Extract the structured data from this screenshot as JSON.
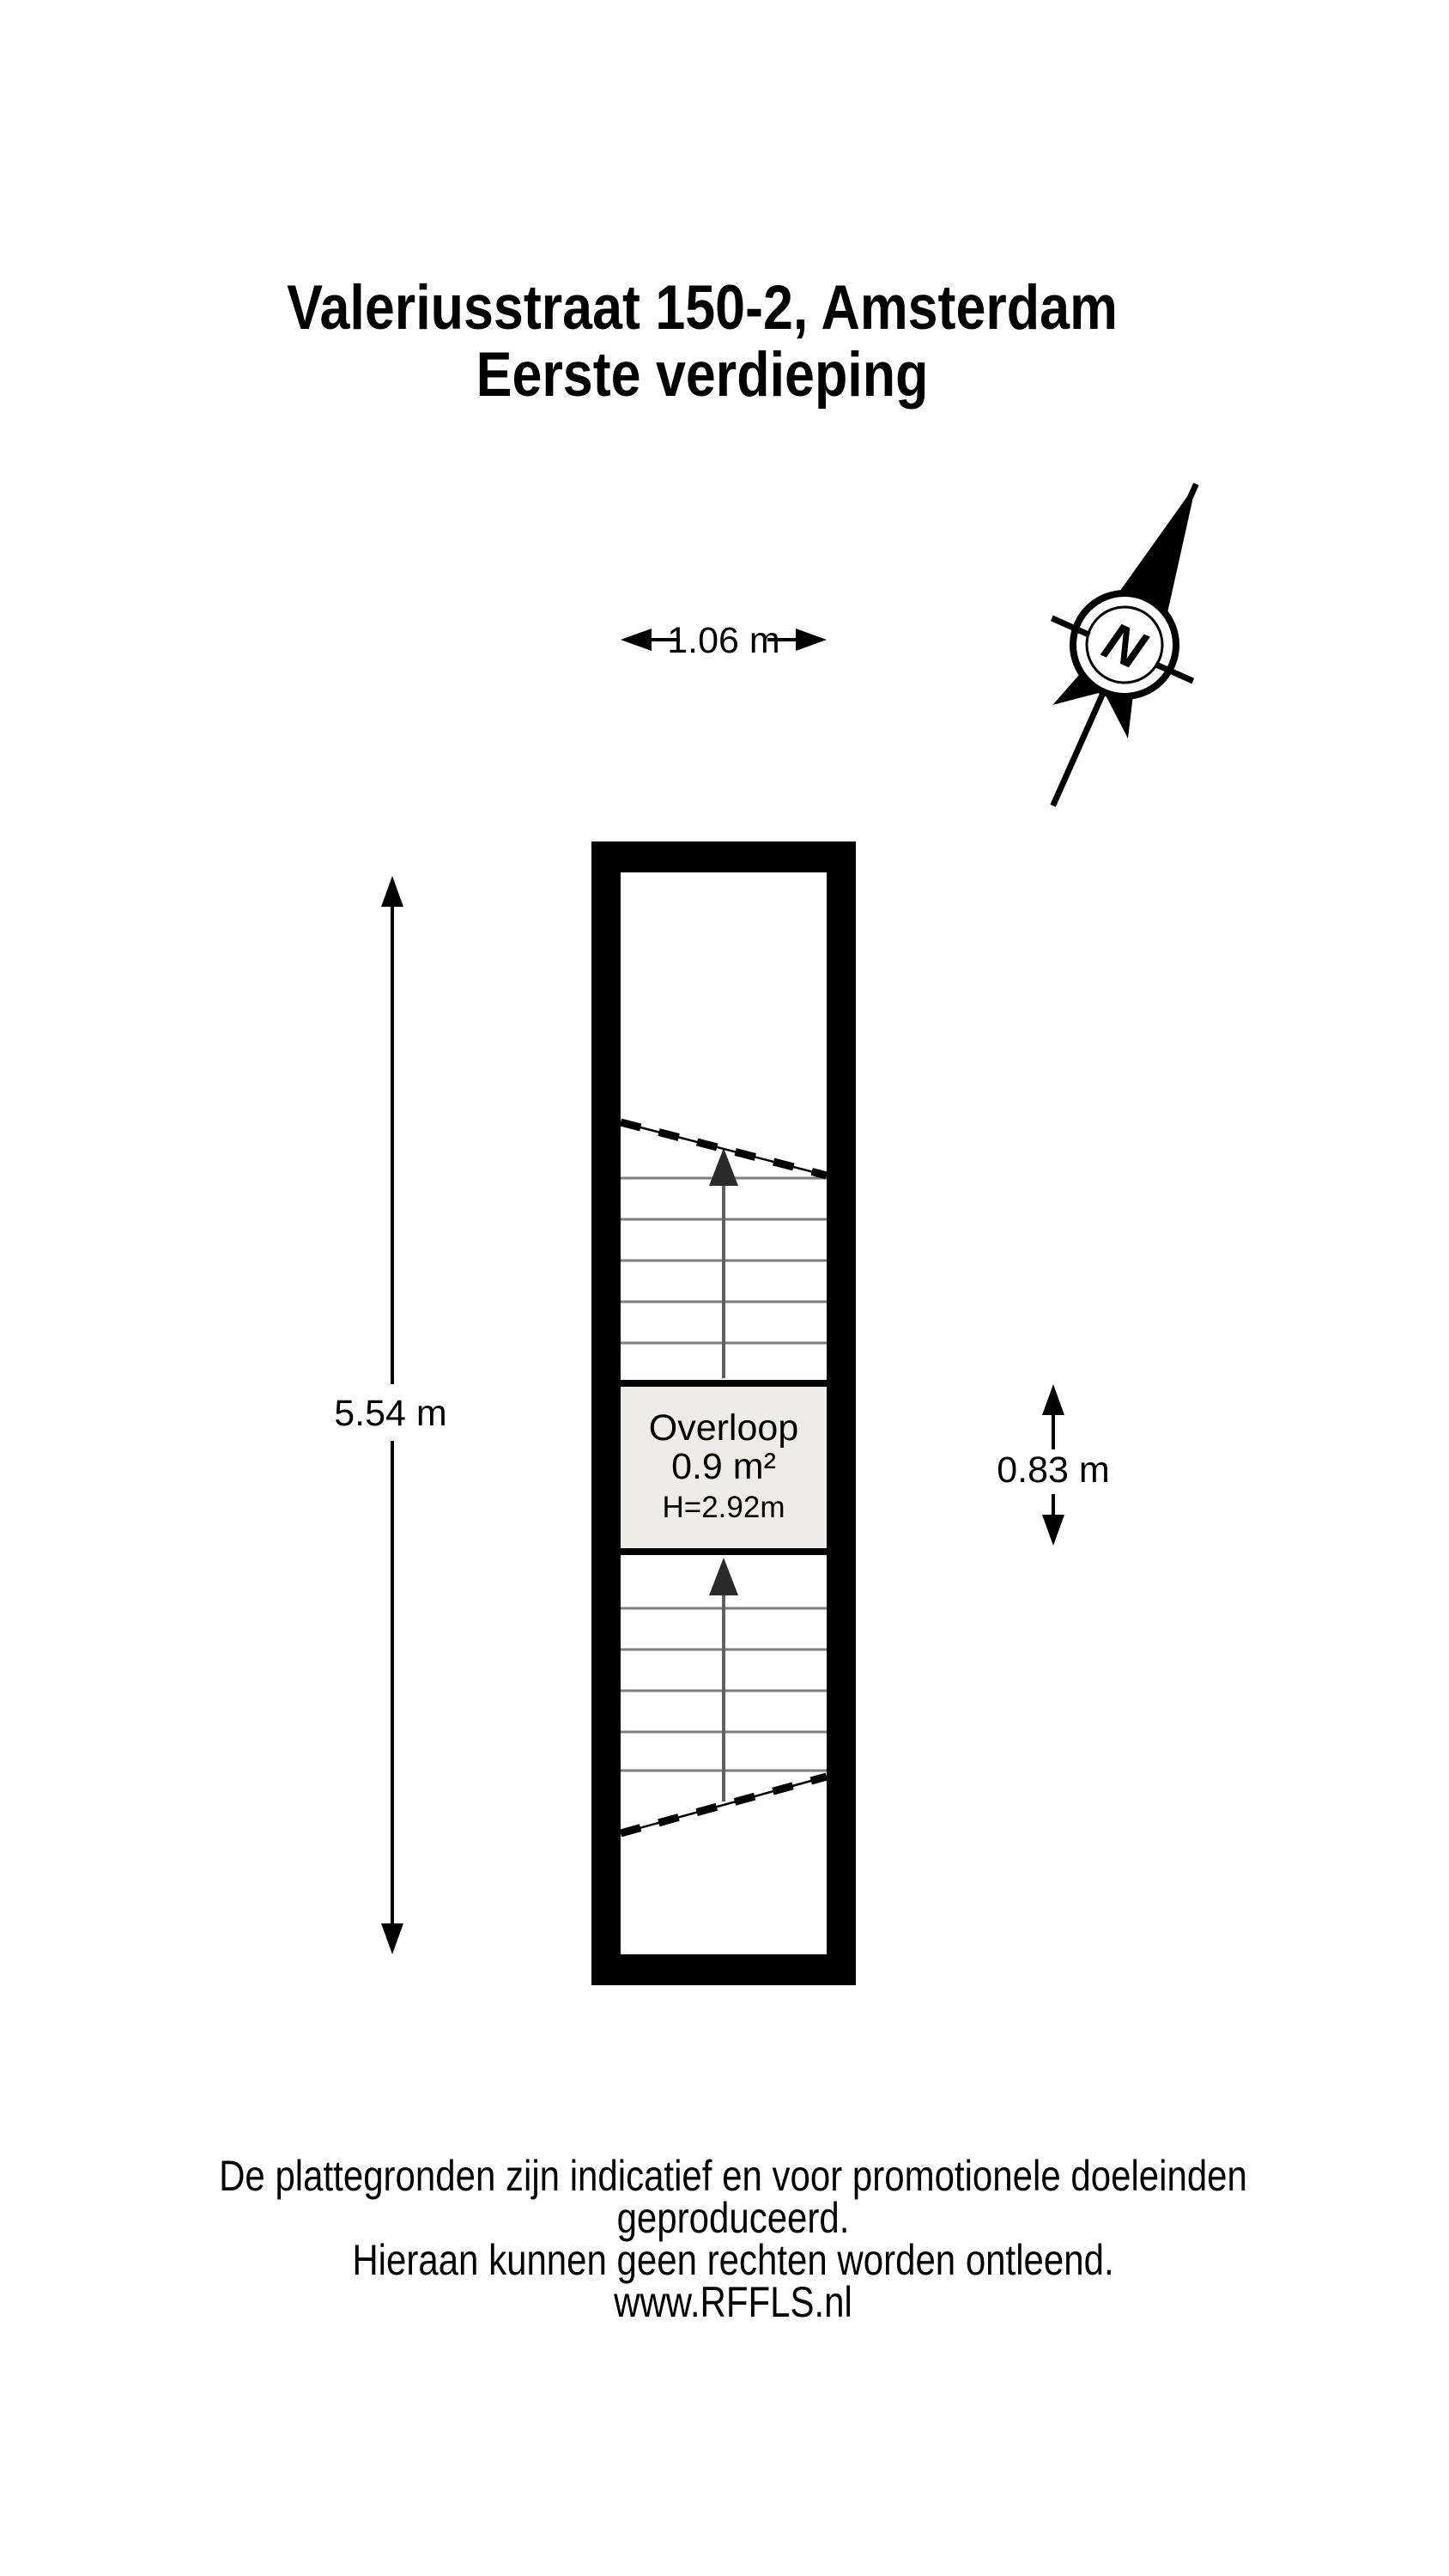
{
  "title": {
    "line1": "Valeriusstraat 150-2, Amsterdam",
    "line2": "Eerste verdieping"
  },
  "compass": {
    "north_label": "N"
  },
  "floor_plan": {
    "room": {
      "name": "Overloop",
      "area": "0.9 m²",
      "ceiling_height": "H=2.92m"
    },
    "dimensions": {
      "interior_width": "1.06 m",
      "interior_height": "5.54 m",
      "landing_depth": "0.83 m"
    }
  },
  "footer": {
    "line1": "De plattegronden zijn indicatief en voor promotionele doeleinden geproduceerd.",
    "line2": "Hieraan kunnen geen rechten worden ontleend.",
    "line3": "www.RFFLS.nl"
  },
  "colors": {
    "ink": "#000000",
    "room_fill": "#edece7",
    "stair_tread": "#7d7d7d",
    "stair_shaft": "#606060",
    "arrow_fill": "#2a2a2a",
    "background": "#ffffff"
  }
}
